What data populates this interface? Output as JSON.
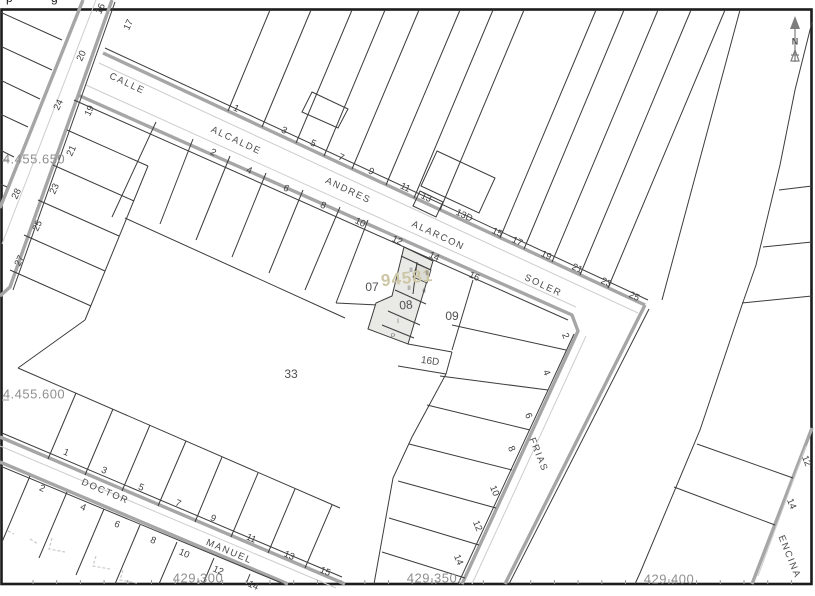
{
  "window": {
    "top_clipped_text": [
      "p",
      "g"
    ]
  },
  "compass": {
    "label": "N"
  },
  "colors": {
    "frame": "#1c1c1c",
    "line": "#3c3c3c",
    "curb": "#a6a6a6",
    "thin": "#cdcdcd",
    "coord": "#8f8f8f",
    "street": "#4b4b4b",
    "num": "#3f3f3f",
    "parcel": "#4f4f4f",
    "block": "#cdc6a5",
    "hl": "#e9e9e5",
    "hl2": "#dcdcd7",
    "faint": "#c9c9c9",
    "compass": "#7d7d7d"
  },
  "grid": {
    "left_labels": [
      {
        "t": "4.455.650",
        "x": 34,
        "y": 159
      },
      {
        "t": "4.455.600",
        "x": 34,
        "y": 394
      }
    ],
    "bottom_labels": [
      {
        "t": "429.300",
        "x": 198,
        "y": 578
      },
      {
        "t": "429.350",
        "x": 432,
        "y": 578
      },
      {
        "t": "429.400",
        "x": 669,
        "y": 579
      }
    ]
  },
  "selected_block_number": "94581",
  "selected_parcel": "08",
  "label_groups": [
    {
      "cls": "coord",
      "name": "coordinate-label",
      "items": [
        {
          "t": "4.455.650",
          "x": 34,
          "y": 159,
          "r": 0
        },
        {
          "t": "4.455.600",
          "x": 34,
          "y": 394,
          "r": 0
        },
        {
          "t": "429.300",
          "x": 198,
          "y": 578,
          "r": 0
        },
        {
          "t": "429.350",
          "x": 432,
          "y": 578,
          "r": 0
        },
        {
          "t": "429.400",
          "x": 669,
          "y": 579,
          "r": 0
        }
      ]
    },
    {
      "cls": "street",
      "name": "street-name-label",
      "items": [
        {
          "t": "CALLE",
          "x": 127,
          "y": 84,
          "r": 25
        },
        {
          "t": "ALCALDE",
          "x": 236,
          "y": 141,
          "r": 25
        },
        {
          "t": "ANDRES",
          "x": 348,
          "y": 191,
          "r": 25
        },
        {
          "t": "ALARCON",
          "x": 438,
          "y": 236,
          "r": 25
        },
        {
          "t": "SOLER",
          "x": 543,
          "y": 286,
          "r": 25
        },
        {
          "t": "DOCTOR",
          "x": 105,
          "y": 492,
          "r": 23
        },
        {
          "t": "MANUEL",
          "x": 229,
          "y": 552,
          "r": 23
        },
        {
          "t": "FRIAS",
          "x": 538,
          "y": 455,
          "r": 68
        },
        {
          "t": "ENCINA",
          "x": 789,
          "y": 557,
          "r": 68
        }
      ]
    },
    {
      "cls": "hn",
      "name": "house-number",
      "items": [
        {
          "t": "1",
          "x": 236,
          "y": 109,
          "r": 25
        },
        {
          "t": "3",
          "x": 284,
          "y": 131,
          "r": 25
        },
        {
          "t": "5",
          "x": 313,
          "y": 144,
          "r": 25
        },
        {
          "t": "7",
          "x": 341,
          "y": 158,
          "r": 25
        },
        {
          "t": "9",
          "x": 371,
          "y": 172,
          "r": 25
        },
        {
          "t": "11",
          "x": 405,
          "y": 188,
          "r": 25
        },
        {
          "t": "13",
          "x": 426,
          "y": 198,
          "r": 25
        },
        {
          "t": "13D",
          "x": 464,
          "y": 216,
          "r": 25
        },
        {
          "t": "15",
          "x": 497,
          "y": 233,
          "r": 25
        },
        {
          "t": "17",
          "x": 517,
          "y": 242,
          "r": 25
        },
        {
          "t": "19",
          "x": 546,
          "y": 256,
          "r": 25
        },
        {
          "t": "21",
          "x": 577,
          "y": 269,
          "r": 25
        },
        {
          "t": "23",
          "x": 606,
          "y": 283,
          "r": 25
        },
        {
          "t": "25",
          "x": 634,
          "y": 297,
          "r": 25
        },
        {
          "t": "2",
          "x": 213,
          "y": 153,
          "r": 25
        },
        {
          "t": "4",
          "x": 249,
          "y": 171,
          "r": 25
        },
        {
          "t": "6",
          "x": 286,
          "y": 189,
          "r": 25
        },
        {
          "t": "8",
          "x": 323,
          "y": 206,
          "r": 25
        },
        {
          "t": "10",
          "x": 360,
          "y": 223,
          "r": 25
        },
        {
          "t": "12",
          "x": 397,
          "y": 241,
          "r": 25
        },
        {
          "t": "14",
          "x": 434,
          "y": 257,
          "r": 25
        },
        {
          "t": "16",
          "x": 474,
          "y": 277,
          "r": 25
        },
        {
          "t": "16",
          "x": 101,
          "y": 9,
          "r": -65
        },
        {
          "t": "20",
          "x": 82,
          "y": 56,
          "r": -65
        },
        {
          "t": "24",
          "x": 59,
          "y": 105,
          "r": -65
        },
        {
          "t": "28",
          "x": 17,
          "y": 194,
          "r": -65
        },
        {
          "t": "17",
          "x": 129,
          "y": 25,
          "r": -65
        },
        {
          "t": "19",
          "x": 90,
          "y": 111,
          "r": -65
        },
        {
          "t": "21",
          "x": 72,
          "y": 151,
          "r": -65
        },
        {
          "t": "23",
          "x": 55,
          "y": 189,
          "r": -65
        },
        {
          "t": "25",
          "x": 38,
          "y": 226,
          "r": -65
        },
        {
          "t": "27",
          "x": 20,
          "y": 261,
          "r": -65
        },
        {
          "t": "1",
          "x": 66,
          "y": 453,
          "r": 23
        },
        {
          "t": "3",
          "x": 104,
          "y": 471,
          "r": 23
        },
        {
          "t": "5",
          "x": 141,
          "y": 488,
          "r": 23
        },
        {
          "t": "7",
          "x": 178,
          "y": 504,
          "r": 23
        },
        {
          "t": "9",
          "x": 213,
          "y": 519,
          "r": 23
        },
        {
          "t": "11",
          "x": 251,
          "y": 539,
          "r": 23
        },
        {
          "t": "13",
          "x": 289,
          "y": 556,
          "r": 23
        },
        {
          "t": "15",
          "x": 325,
          "y": 572,
          "r": 23
        },
        {
          "t": "2",
          "x": 42,
          "y": 489,
          "r": 23
        },
        {
          "t": "4",
          "x": 83,
          "y": 508,
          "r": 23
        },
        {
          "t": "6",
          "x": 117,
          "y": 525,
          "r": 23
        },
        {
          "t": "8",
          "x": 153,
          "y": 541,
          "r": 23
        },
        {
          "t": "10",
          "x": 184,
          "y": 554,
          "r": 23
        },
        {
          "t": "12",
          "x": 218,
          "y": 571,
          "r": 23
        },
        {
          "t": "14",
          "x": 253,
          "y": 586,
          "r": 23
        },
        {
          "t": "2",
          "x": 565,
          "y": 336,
          "r": 68
        },
        {
          "t": "4",
          "x": 546,
          "y": 373,
          "r": 68
        },
        {
          "t": "6",
          "x": 528,
          "y": 416,
          "r": 68
        },
        {
          "t": "8",
          "x": 511,
          "y": 449,
          "r": 68
        },
        {
          "t": "10",
          "x": 494,
          "y": 491,
          "r": 68
        },
        {
          "t": "12",
          "x": 477,
          "y": 526,
          "r": 68
        },
        {
          "t": "14",
          "x": 458,
          "y": 560,
          "r": 68
        },
        {
          "t": "12",
          "x": 806,
          "y": 461,
          "r": 68
        },
        {
          "t": "14",
          "x": 791,
          "y": 504,
          "r": 68
        }
      ]
    },
    {
      "cls": "pn",
      "name": "parcel-number",
      "items": [
        {
          "t": "07",
          "x": 372,
          "y": 287,
          "r": 0
        },
        {
          "t": "08",
          "x": 406,
          "y": 305,
          "r": -6
        },
        {
          "t": "09",
          "x": 452,
          "y": 316,
          "r": 0
        },
        {
          "t": "33",
          "x": 291,
          "y": 374,
          "r": 0
        }
      ]
    },
    {
      "cls": "sm",
      "name": "parcel-number",
      "items": [
        {
          "t": "16D",
          "x": 430,
          "y": 362,
          "r": 8
        }
      ]
    },
    {
      "cls": "blk",
      "name": "block-number",
      "items": [
        {
          "t": "94581",
          "x": 407,
          "y": 278,
          "r": -6
        }
      ]
    },
    {
      "cls": "fl",
      "name": "floor-count-label",
      "items": [
        {
          "t": "II",
          "x": 411,
          "y": 271,
          "r": 0
        },
        {
          "t": "II",
          "x": 427,
          "y": 274,
          "r": 0
        },
        {
          "t": "II",
          "x": 409,
          "y": 289,
          "r": 0
        },
        {
          "t": "II",
          "x": 424,
          "y": 292,
          "r": 0
        },
        {
          "t": "I",
          "x": 398,
          "y": 322,
          "r": 0
        },
        {
          "t": "P",
          "x": 393,
          "y": 337,
          "r": 0
        }
      ]
    }
  ]
}
